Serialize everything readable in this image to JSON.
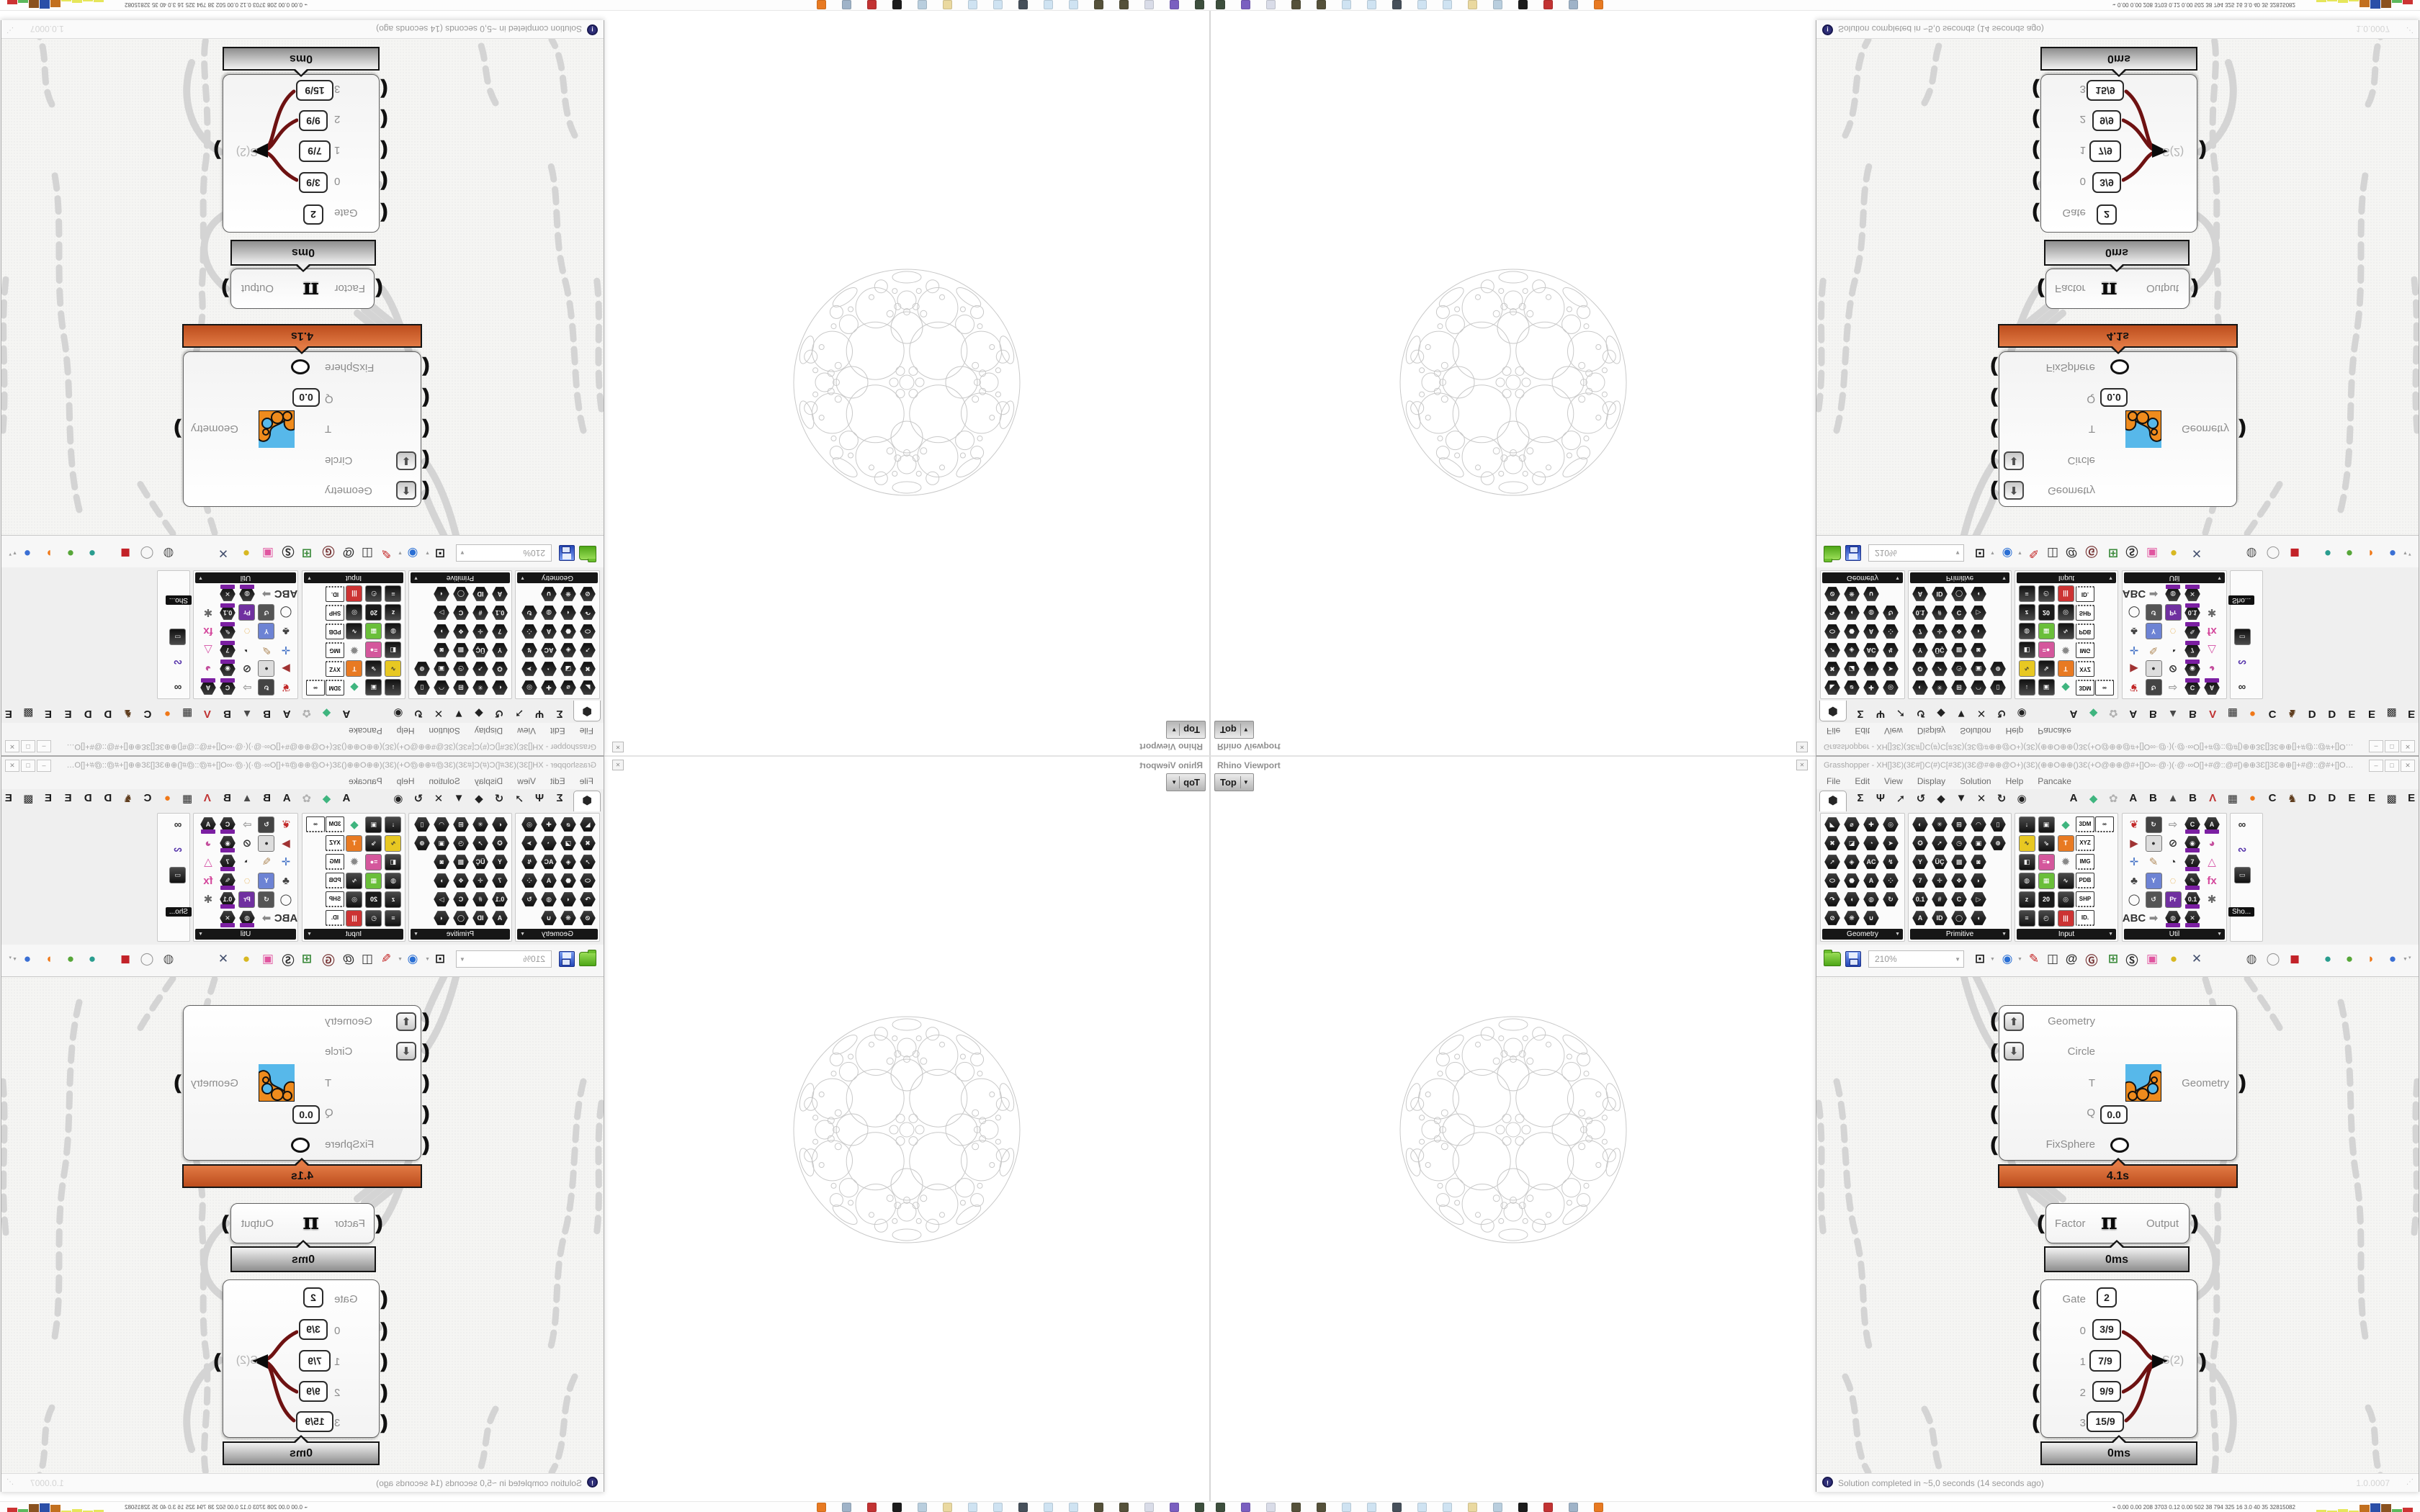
{
  "rhino_viewport": {
    "title": "Rhino Viewport",
    "viewport_tab": "Top",
    "tab_arrow": "▼",
    "close_glyph": "✕"
  },
  "grasshopper": {
    "title": "Grasshopper - XH[]3Ɛ)(3Ɛ#[)C(#)C[#3Ɛ)(3Ɛ@#⊕⊕@O+)(3Ɛ)(⊕⊕O⊕⊕()3Ɛ(+O@⊕⊕@#+[]O∞·@·)(·@·∞O[]+#@::@#[)⊕⊕3Ɛ[]3Ɛ⊕⊕[]+#@::@#+[]O∞·@)(·@·∞O[]#+@@⊕⊕@O+)(3Ɛ)(⊕⊕O⊕⊕()⊕⊕…",
    "window_buttons": [
      "–",
      "□",
      "✕"
    ],
    "menu": [
      "File",
      "Edit",
      "View",
      "Display",
      "Solution",
      "Help",
      "Pancake"
    ],
    "tabs_standard": [
      "⬢",
      "Σ",
      "Ψ",
      "➚",
      "↺",
      "◆",
      "▼",
      "✕",
      "↻",
      "◉"
    ],
    "tabs_plugins": [
      [
        "A",
        "#1a1a1a"
      ],
      [
        "◆",
        "#3fb57f"
      ],
      [
        "✿",
        "#b0b0b0"
      ],
      [
        "A",
        "#1a1a1a"
      ],
      [
        "B",
        "#1a1a1a"
      ],
      [
        "▲",
        "#4a4a4a"
      ],
      [
        "B",
        "#1a1a1a"
      ],
      [
        "Ʌ",
        "#c03333"
      ],
      [
        "▦",
        "#2a2a2a"
      ],
      [
        "●",
        "#f07818"
      ],
      [
        "C",
        "#1a1a1a"
      ],
      [
        "♞",
        "#5f3d1e"
      ],
      [
        "D",
        "#1a1a1a"
      ],
      [
        "D",
        "#1a1a1a"
      ],
      [
        "E",
        "#1a1a1a"
      ],
      [
        "E",
        "#1a1a1a"
      ],
      [
        "▩",
        "#2a2a2a"
      ],
      [
        "E",
        "#1a1a1a"
      ]
    ],
    "ribbon_groups": [
      {
        "label": "Geometry",
        "icons": [
          "h:◣",
          "h:⌀",
          "h:✚",
          "h:◎",
          "h:✖",
          "h:◪",
          "h:◔",
          "h:➤",
          "h:➚",
          "h:◈",
          "h:AC",
          "h:↯",
          "h:⬭",
          "h:⬣",
          "h:A",
          "h:⁘",
          "h:↷",
          "h:◖",
          "h:◍",
          "h:↻",
          "h:⊘",
          "h:❋",
          "h:∪"
        ]
      },
      {
        "label": "Primitive",
        "icons": [
          "h:◐",
          "h:✳",
          "h:⊞",
          "h:◠",
          "h:▯",
          "h:✪",
          "h:➚",
          "h:◷",
          "h:▣",
          "h:⊕",
          "h:Y",
          "h:ÜÇ",
          "h:▩",
          "h:◙",
          "",
          "h:7",
          "h:✛",
          "h:❖",
          "h:◗",
          "",
          "h:0.1",
          "h:#",
          "h:C:/",
          "h:▷",
          "",
          "h:A",
          "h:ID",
          "h:◯",
          "h:◖",
          ""
        ]
      },
      {
        "label": "Input",
        "icons": [
          "s:↓",
          "s:▣",
          "g:#3fb57f:◆",
          "t:3DM",
          "t:∞",
          "b:#e8c822:∿",
          "s:⇘",
          "b:#e87a22:T",
          "t:XYZ",
          "",
          "s:◧",
          "b:#d4579c:=●",
          "g:#888:✹",
          "t:IMG",
          "",
          "s:◍",
          "b:#6abf3a:▦",
          "s:∿",
          "t:PDB",
          "",
          "s:z",
          "b:#1a1a1a:20",
          "s:◎",
          "t:SHP",
          "",
          "s:≡",
          "s:◴",
          "b:#cc3333:|||",
          "t:ID.",
          ""
        ]
      },
      {
        "label": "Util",
        "icons": [
          "g:#c22a2a:❦",
          "b:#444444:↻",
          "g:#9a9a9a:⇨",
          "p:C:/",
          "p:A",
          "g:#a03333:▶",
          "b:#dddddd:●",
          "g:#333333:⊘",
          "p:◉",
          "g:#c4509e:◕",
          "g:#3b6cc4:✛",
          "g:#b08a5a:✎",
          "g:#333333:◔",
          "p:7",
          "g:#d44fa4:△",
          "g:#444444:♣",
          "b:#6d83d4:Y",
          "g:#e0a030:◌",
          "p:✎",
          "g:#d4479c:fx",
          "g:#333333:◯",
          "b:#555555:↺",
          "b:#7030a0:Pr",
          "p:0.1",
          "g:#666666:✱",
          "g:#333333:ABC",
          "g:#888888:➡",
          "p:◍",
          "p:✕",
          ""
        ]
      }
    ],
    "ribbon_extra_icons": [
      "g:#333333:∞",
      "g:#5533aa:∾",
      "s:▭"
    ],
    "ribbon_tooltip": "Sho...",
    "toolbar": {
      "zoom_level": "210%",
      "icons": [
        "open-file",
        "save-file",
        "zoom-selector",
        "zoom-extents",
        "preview-eye",
        "sketch-pen",
        "exposé",
        "remote-panel",
        "gha-assembly",
        "gallery",
        "search",
        "unknown-package",
        "idea-bulb",
        "jump-wires",
        "preview-off",
        "preview-wire",
        "preview-shaded",
        "display-teal",
        "display-green",
        "display-orange",
        "display-blue"
      ]
    },
    "canvas_nodes": {
      "fixsphere": {
        "inputs": [
          "Geometry",
          "Circle",
          "T",
          "Q",
          "FixSphere"
        ],
        "q_value": "0.0",
        "output": "Geometry",
        "profile_time": "4.1s"
      },
      "factor": {
        "input": "Factor",
        "symbol": "π",
        "output": "Output",
        "profile_time": "0ms"
      },
      "gate": {
        "rows": [
          [
            "Gate",
            "2"
          ],
          [
            "0",
            "3/9"
          ],
          [
            "1",
            "7/9"
          ],
          [
            "2",
            "9/9"
          ],
          [
            "3",
            "15/9"
          ]
        ],
        "selected_row": "1",
        "output": "S(2)",
        "profile_time": "0ms"
      }
    },
    "statusbar": {
      "message": "Solution completed in ~5,0 seconds (14 seconds ago)",
      "version": "1.0.0007"
    }
  },
  "taskbar": {
    "icon_names": [
      "app-dark",
      "save64-app",
      "script-app",
      "grasshopper-a",
      "grasshopper-b",
      "notepad-1",
      "notepad-2",
      "monitor-app",
      "notepad-3",
      "notepad-4",
      "folder-app",
      "pc-app",
      "contrast-app",
      "red-app",
      "calculator-app",
      "firefox"
    ],
    "icon_colors": [
      "#3d4f3d",
      "#7a5fc0",
      "#d9dce8",
      "#55513a",
      "#55513a",
      "#cfe3f2",
      "#cfe3f2",
      "#46505a",
      "#cfe3f2",
      "#cfe3f2",
      "#ead9a0",
      "#b9cede",
      "#1c1c1c",
      "#c23333",
      "#9fb3c8",
      "#e87a22"
    ],
    "stats": "0.00 0.00 208 3703 0.12 0.00 502 38 794 325 16 3.0 40 35 32815082",
    "chart_colors": [
      "#e6e65a",
      "#e6e65a",
      "#e6e65a",
      "#e6e65a",
      "#c2701f",
      "#2b4fa8",
      "#8a5220",
      "#5cb85c",
      "#cc3333"
    ],
    "chart_heights": [
      3,
      2,
      4,
      2,
      10,
      12,
      11,
      4,
      6
    ]
  },
  "colors": {
    "profiler_orange": "#d2622d",
    "profiler_gray": "#bdbdbd",
    "wire_gray": "#d4d4d4",
    "sphere_stroke": "#c9c9c9",
    "badge_purple": "#7b1fa2"
  }
}
